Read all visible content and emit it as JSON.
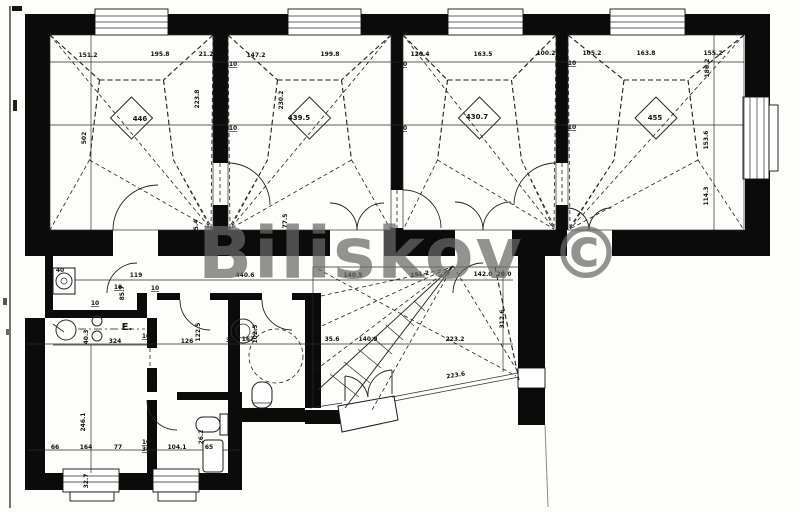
{
  "watermark": {
    "text": "Biliskov ©"
  },
  "plan": {
    "area_labels": [
      {
        "text": "446",
        "x": 140,
        "y": 121
      },
      {
        "text": "439.5",
        "x": 299,
        "y": 120
      },
      {
        "text": "430.7",
        "x": 477,
        "y": 119
      },
      {
        "text": "455",
        "x": 655,
        "y": 120
      }
    ],
    "dim_labels": [
      {
        "text": "151.2",
        "x": 88,
        "y": 57
      },
      {
        "text": "195.8",
        "x": 160,
        "y": 56
      },
      {
        "text": "21.2",
        "x": 206,
        "y": 56
      },
      {
        "text": "147.2",
        "x": 256,
        "y": 57
      },
      {
        "text": "199.8",
        "x": 330,
        "y": 56
      },
      {
        "text": "120.4",
        "x": 420,
        "y": 56
      },
      {
        "text": "163.5",
        "x": 483,
        "y": 56
      },
      {
        "text": "100.2",
        "x": 546,
        "y": 55
      },
      {
        "text": "105.2",
        "x": 592,
        "y": 55
      },
      {
        "text": "163.8",
        "x": 646,
        "y": 55
      },
      {
        "text": "155.2",
        "x": 713,
        "y": 55
      },
      {
        "text": "10",
        "x": 233,
        "y": 66,
        "underline": true
      },
      {
        "text": "10",
        "x": 233,
        "y": 130,
        "underline": true
      },
      {
        "text": "10",
        "x": 403,
        "y": 66,
        "underline": true
      },
      {
        "text": "10",
        "x": 403,
        "y": 130,
        "underline": true
      },
      {
        "text": "10",
        "x": 572,
        "y": 65,
        "underline": true
      },
      {
        "text": "10",
        "x": 572,
        "y": 129,
        "underline": true
      },
      {
        "text": "502",
        "x": 86,
        "y": 138,
        "rot": -90
      },
      {
        "text": "223.8",
        "x": 199,
        "y": 99,
        "rot": -90
      },
      {
        "text": "230.2",
        "x": 283,
        "y": 100,
        "rot": -90
      },
      {
        "text": "186.2",
        "x": 709,
        "y": 68,
        "rot": -90
      },
      {
        "text": "153.6",
        "x": 708,
        "y": 140,
        "rot": -90
      },
      {
        "text": "114.3",
        "x": 708,
        "y": 196,
        "rot": -90
      },
      {
        "text": "75.4",
        "x": 198,
        "y": 227,
        "rot": -90
      },
      {
        "text": "77.5",
        "x": 287,
        "y": 221,
        "rot": -90
      },
      {
        "text": "40",
        "x": 60,
        "y": 272
      },
      {
        "text": "119",
        "x": 136,
        "y": 277
      },
      {
        "text": "440.6",
        "x": 245,
        "y": 277
      },
      {
        "text": "140.5",
        "x": 353,
        "y": 277
      },
      {
        "text": "191.2",
        "x": 420,
        "y": 276,
        "rot": -8
      },
      {
        "text": "142.0",
        "x": 483,
        "y": 276
      },
      {
        "text": "20.0",
        "x": 504,
        "y": 276
      },
      {
        "text": "10",
        "x": 118,
        "y": 289,
        "underline": true
      },
      {
        "text": "10",
        "x": 155,
        "y": 290,
        "underline": true
      },
      {
        "text": "85.7",
        "x": 124,
        "y": 293,
        "rot": -90
      },
      {
        "text": "10",
        "x": 95,
        "y": 305,
        "underline": true
      },
      {
        "text": "40.3",
        "x": 88,
        "y": 337,
        "rot": -90
      },
      {
        "text": "E.",
        "x": 127,
        "y": 330,
        "cls": "big"
      },
      {
        "text": "324",
        "x": 115,
        "y": 343
      },
      {
        "text": "10",
        "x": 146,
        "y": 338,
        "underline": true
      },
      {
        "text": "126",
        "x": 187,
        "y": 343
      },
      {
        "text": "122.5",
        "x": 200,
        "y": 332,
        "rot": -90
      },
      {
        "text": "34",
        "x": 230,
        "y": 342
      },
      {
        "text": "102.5",
        "x": 257,
        "y": 334,
        "rot": -90
      },
      {
        "text": "167",
        "x": 248,
        "y": 341
      },
      {
        "text": "35.6",
        "x": 332,
        "y": 341
      },
      {
        "text": "140.9",
        "x": 368,
        "y": 341
      },
      {
        "text": "223.2",
        "x": 455,
        "y": 341
      },
      {
        "text": "312.6",
        "x": 504,
        "y": 319,
        "rot": -90
      },
      {
        "text": "223.6",
        "x": 456,
        "y": 377,
        "rot": -9
      },
      {
        "text": "246.1",
        "x": 85,
        "y": 422,
        "rot": -90
      },
      {
        "text": "102",
        "x": 155,
        "y": 382,
        "rot": -90
      },
      {
        "text": "32.7",
        "x": 88,
        "y": 481,
        "rot": -90
      },
      {
        "text": "66",
        "x": 55,
        "y": 449
      },
      {
        "text": "164",
        "x": 86,
        "y": 449
      },
      {
        "text": "77",
        "x": 118,
        "y": 449
      },
      {
        "text": "10",
        "x": 146,
        "y": 444,
        "underline": true
      },
      {
        "text": "36",
        "x": 146,
        "y": 451,
        "underline": true
      },
      {
        "text": "104.1",
        "x": 177,
        "y": 449
      },
      {
        "text": "65",
        "x": 209,
        "y": 449
      },
      {
        "text": "26.2",
        "x": 203,
        "y": 437,
        "rot": -90
      }
    ]
  }
}
